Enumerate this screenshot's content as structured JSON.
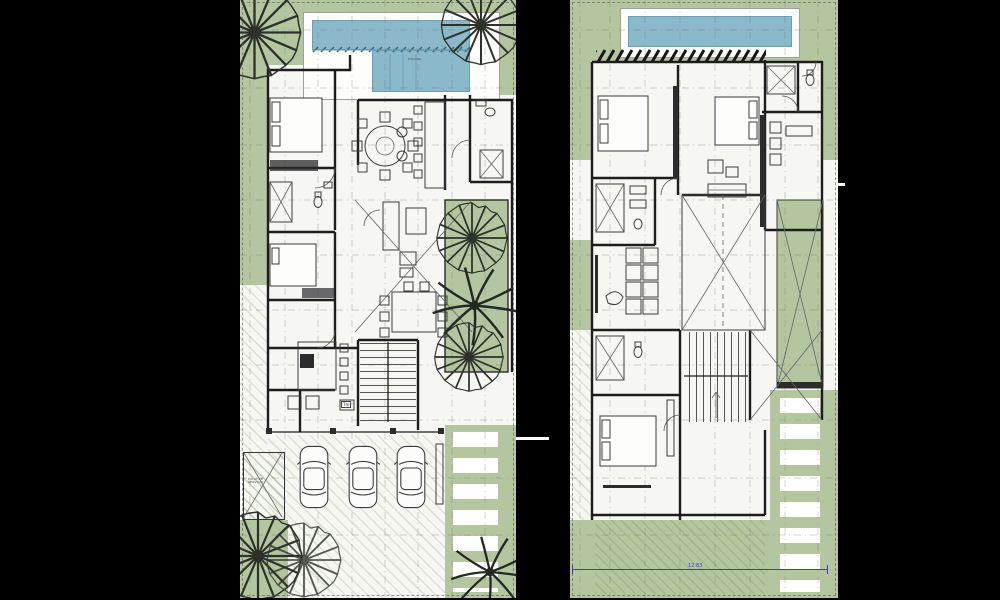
{
  "colors": {
    "background": "#000000",
    "paper": "#f6f6f3",
    "green": "#b4c6a0",
    "pool": "#8ab9c9",
    "pool-edge": "#6d9fb3",
    "wall": "#1d1d1d",
    "grid": "#666666",
    "dim": "#3a3ad6"
  },
  "ground_floor": {
    "name": "ground-floor-plan",
    "pool_label": "PISCINA",
    "stair_label": "Tm",
    "service_patio_label": "PATIO DE SERVICIO",
    "car_count": "3"
  },
  "upper_floor": {
    "name": "upper-floor-plan",
    "dimension_label": "12.83"
  }
}
